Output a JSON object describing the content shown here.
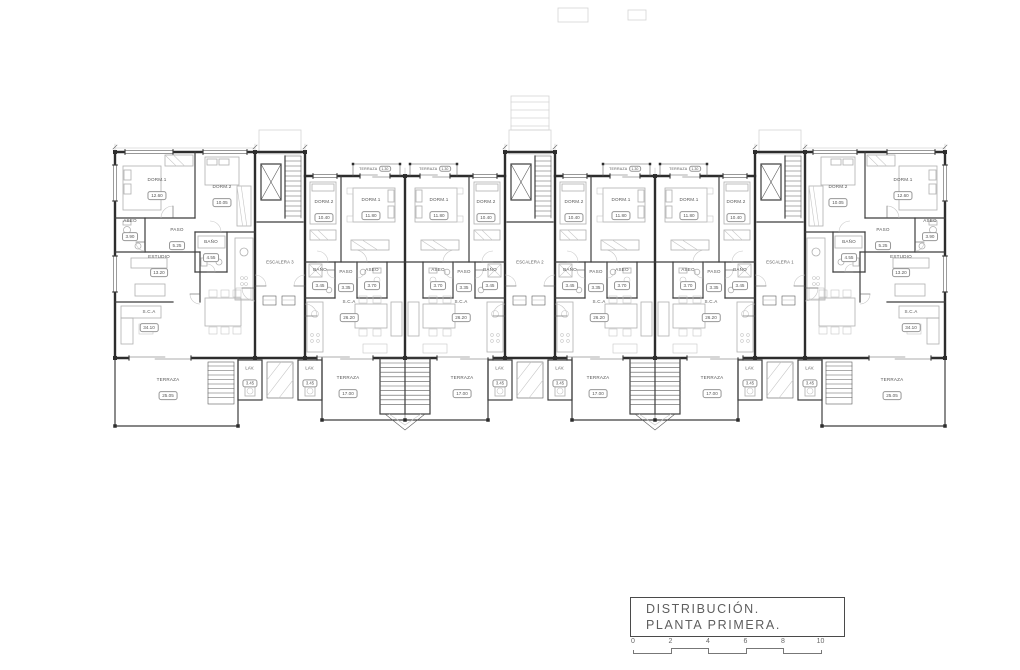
{
  "drawing": {
    "title_block": {
      "line1": "DISTRIBUCIÓN.",
      "line2": "PLANTA PRIMERA."
    },
    "scale_labels": [
      "0",
      "2",
      "4",
      "6",
      "8",
      "10"
    ],
    "stairwells": [
      {
        "label": "ESCALERA 3"
      },
      {
        "label": "ESCALERA 2"
      },
      {
        "label": "ESCALERA 1"
      }
    ],
    "room_types": {
      "end": {
        "dorm1": {
          "name": "DORM.1",
          "area": "12.60"
        },
        "dorm2": {
          "name": "DORM.2",
          "area": "10.05"
        },
        "aseo": {
          "name": "ASEO",
          "area": "3.90"
        },
        "paso": {
          "name": "PASO",
          "area": "5.25"
        },
        "bano": {
          "name": "BAÑO",
          "area": "4.55"
        },
        "estudio": {
          "name": "ESTUDIO",
          "area": "13.20"
        },
        "sca": {
          "name": "S.C.A",
          "area": "34.10"
        },
        "terraza": {
          "name": "TERRAZA",
          "area": "25.05"
        },
        "lav": {
          "name": "LAV.",
          "area": "3.45"
        }
      },
      "mid": {
        "dorm1": {
          "name": "DORM.1",
          "area": "11.80"
        },
        "dorm2": {
          "name": "DORM.2",
          "area": "10.40"
        },
        "aseo": {
          "name": "ASEO",
          "area": "3.70"
        },
        "paso": {
          "name": "PASO",
          "area": "3.35"
        },
        "bano": {
          "name": "BAÑO",
          "area": "3.45"
        },
        "sca": {
          "name": "S.C.A",
          "area": "26.20"
        },
        "balcon": {
          "name": "TERRAZA",
          "area": "1.30"
        },
        "terraza": {
          "name": "TERRAZA",
          "area": "17.00"
        },
        "lav": {
          "name": "LAV.",
          "area": "3.45"
        }
      }
    },
    "units": [
      {
        "id": "u1",
        "type": "end"
      },
      {
        "id": "u2",
        "type": "mid"
      },
      {
        "id": "u3",
        "type": "mid"
      },
      {
        "id": "u4",
        "type": "mid"
      },
      {
        "id": "u5",
        "type": "mid"
      },
      {
        "id": "u6",
        "type": "end"
      }
    ],
    "colors": {
      "wall": "#2d2d2d",
      "furniture": "#b0b0b0",
      "label": "#555555"
    }
  }
}
